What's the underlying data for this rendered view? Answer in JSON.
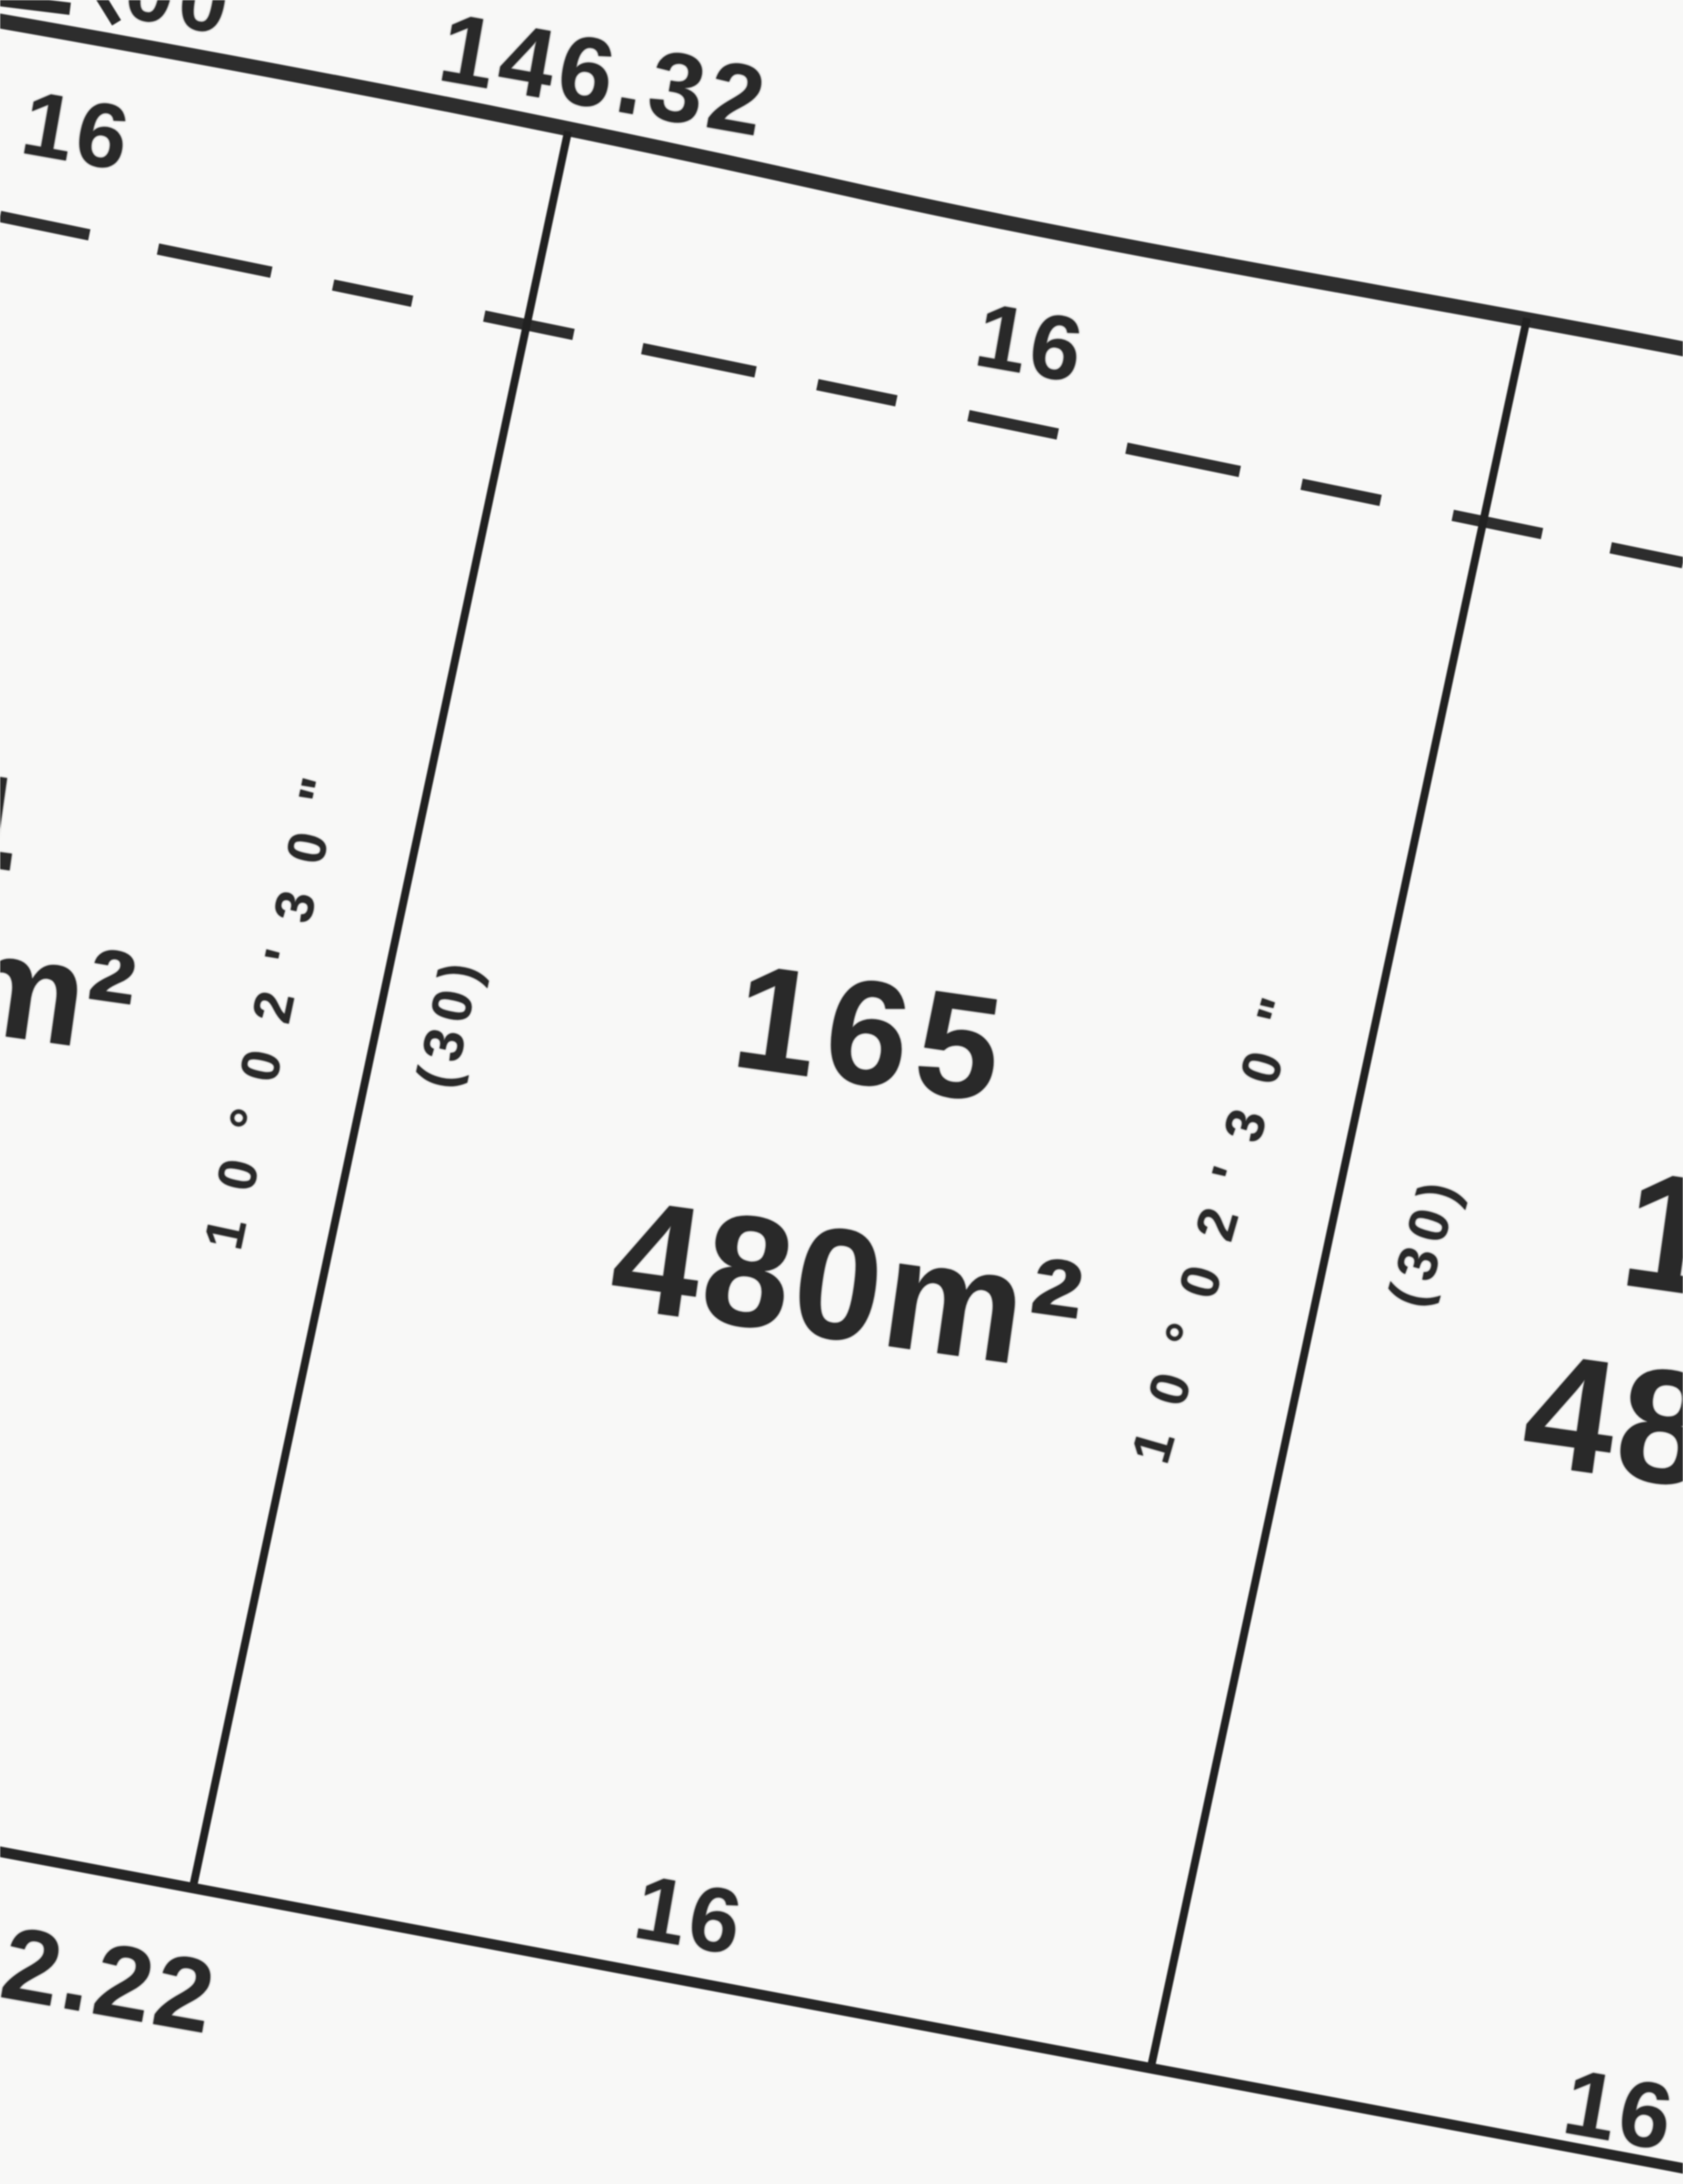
{
  "plan": {
    "type": "cadastral-subdivision-plan-detail",
    "lot": {
      "number": "165",
      "area": "480m²",
      "depth": "(30)",
      "frontage": "16"
    }
  },
  "labels": {
    "top_partial_number": "00",
    "frontage_total": "146.32",
    "frontage_width_left_lot": "16",
    "frontage_width_lot165": "16",
    "bearing_left": "10°02'30\"",
    "distance_left": "(30)",
    "lot_number": "165",
    "lot_area": "480m²",
    "bearing_right": "10°02'30\"",
    "distance_right": "(30)",
    "neighbor_right_lot_fragment": "1",
    "neighbor_right_area_fragment": "48",
    "neighbor_left_lot_fragment": "4",
    "neighbor_left_area_fragment": "m²",
    "bottom_dimension": "2.22",
    "bottom_width_lot165": "16",
    "bottom_width_right_lot": "16"
  },
  "colors": {
    "ink": "#2b2b2b",
    "paper": "#f8f8f7",
    "line": "#303030"
  }
}
